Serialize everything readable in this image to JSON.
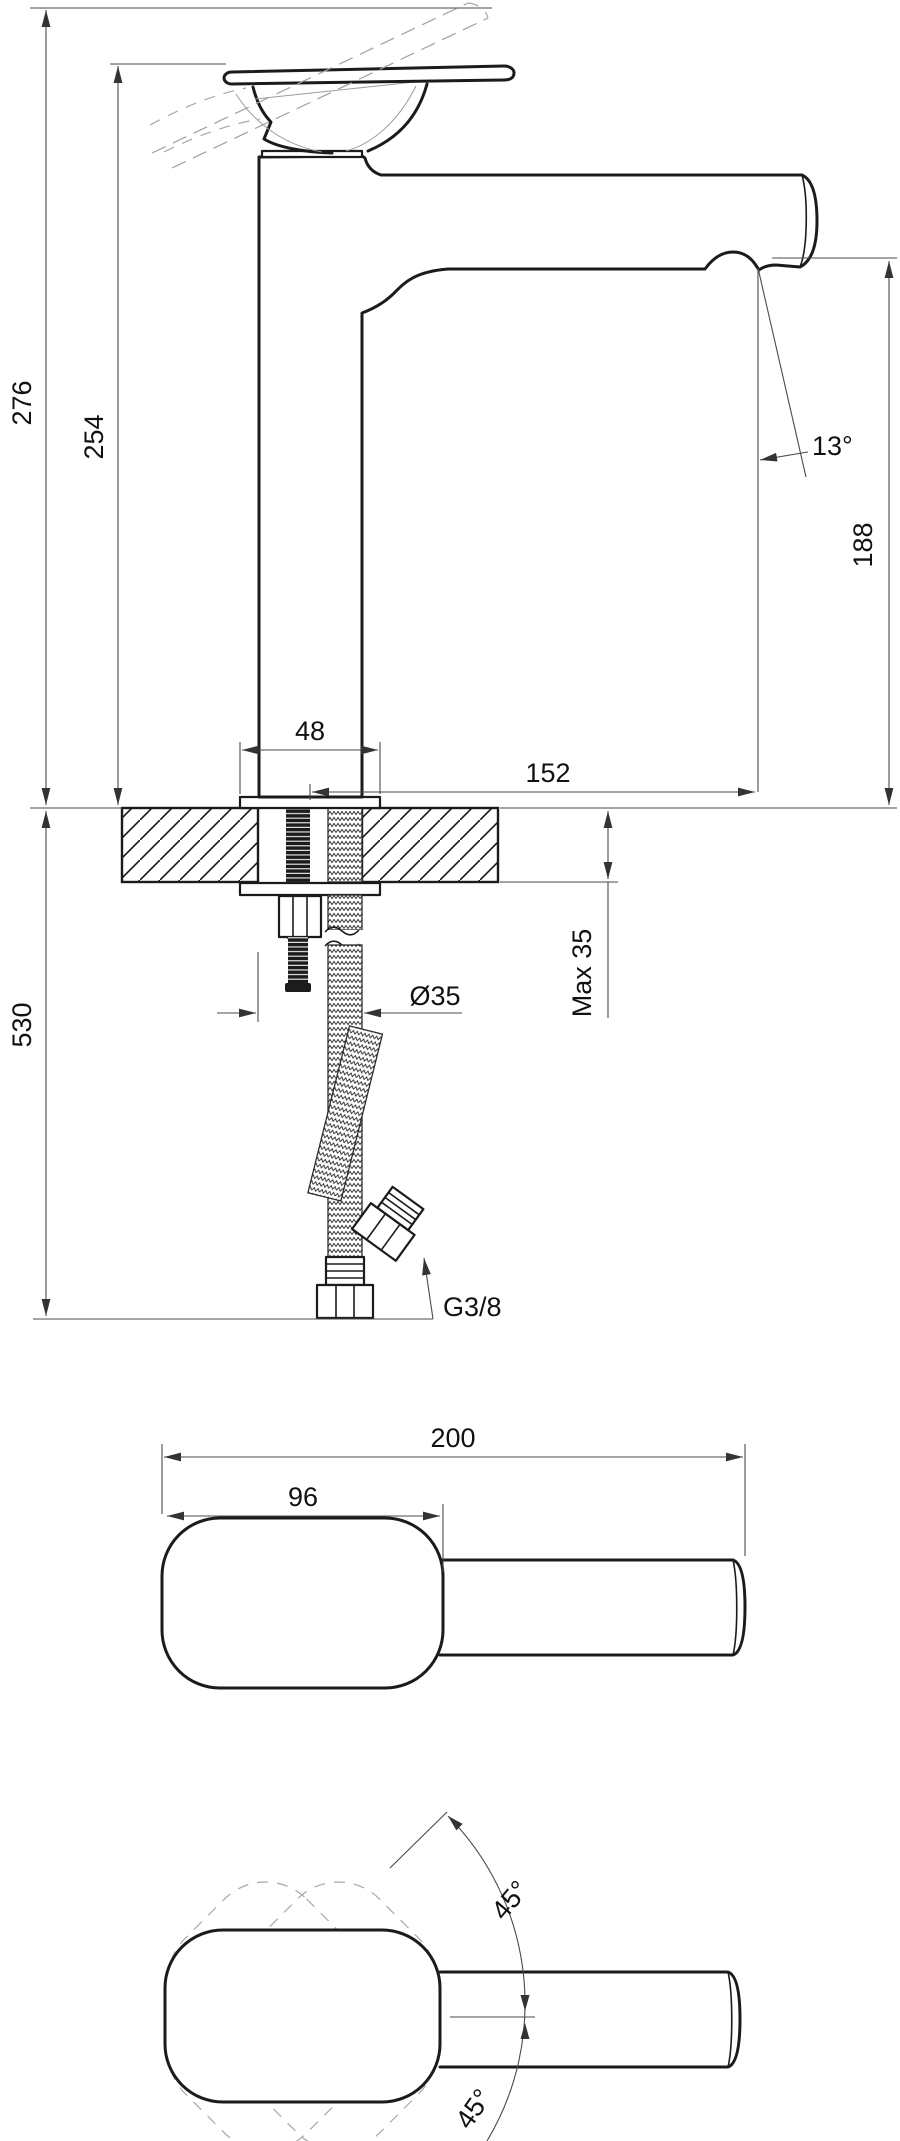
{
  "drawing": {
    "side_view": {
      "overall_height": "276",
      "body_height": "254",
      "base_width": "48",
      "spout_reach": "152",
      "outlet_angle": "13°",
      "outlet_height": "188",
      "hole_diameter": "Ø35",
      "deck_max_thickness": "Max 35",
      "hose_length": "530",
      "hose_thread": "G3/8"
    },
    "top_view": {
      "overall_length": "200",
      "body_length": "96"
    },
    "swivel_view": {
      "swivel_upper": "45°",
      "swivel_lower": "45°"
    }
  }
}
